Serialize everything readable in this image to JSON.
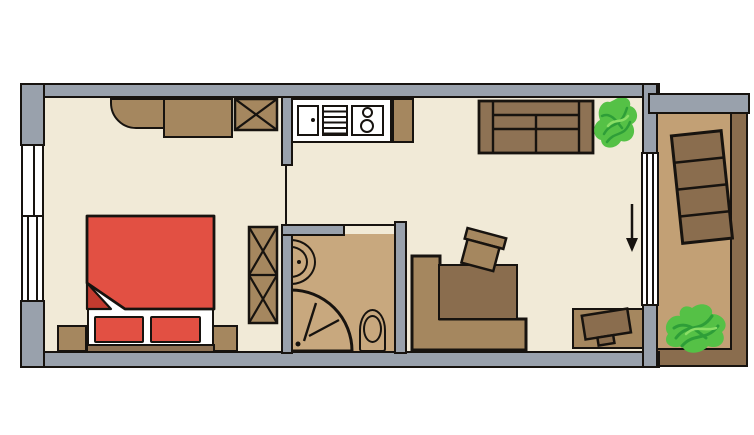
{
  "view": {
    "type": "apartment-floor-plan",
    "orientation": "top-down",
    "visible_text": "none"
  },
  "rooms": [
    "bedroom",
    "kitchen-living-room",
    "bathroom",
    "balcony"
  ],
  "elements": {
    "bedroom": [
      "corner-cabinet-rounded",
      "dresser",
      "wardrobe-crossed",
      "tall-wardrobe-crossed-double",
      "double-bed-red-duvet-folded-corner",
      "pillow-left",
      "pillow-right",
      "bed-base",
      "nightstand-left",
      "nightstand-right",
      "window-upper-left",
      "window-lower-left",
      "door-opening-to-kitchen"
    ],
    "kitchen": [
      "kitchen-counter",
      "sink-with-faucet-dot",
      "drainboard-striped",
      "stove-two-burners",
      "counter-cabinet"
    ],
    "living_room": [
      "sofa-two-seats",
      "potted-plant",
      "corner-bench",
      "dining-table",
      "chair-tilted",
      "tv-table",
      "tv-tilted",
      "entry-direction-arrow",
      "glazed-balcony-door"
    ],
    "bathroom": [
      "washbasin-d-shape",
      "corner-shower-quarter-circle",
      "toilet",
      "door-opening-to-living"
    ],
    "balcony": [
      "lounge-chair-four-segments-tilted",
      "potted-plant",
      "railing-frame"
    ]
  },
  "colors": {
    "background": "#ffffff",
    "floor": "#f1ead7",
    "wall": "#99a1ac",
    "outline": "#17130f",
    "tile": "#c8a87e",
    "balcony-floor": "#c2a075",
    "wood-light": "#a5875f",
    "wood-mid": "#8e7254",
    "wood-dark": "#8a6d4e",
    "bed-red": "#e25043",
    "bed-red-dark": "#c23b2f",
    "white": "#ffffff",
    "plant-green": "#55c146",
    "plant-dark": "#2e9e38",
    "plant-light": "#8ade66"
  }
}
